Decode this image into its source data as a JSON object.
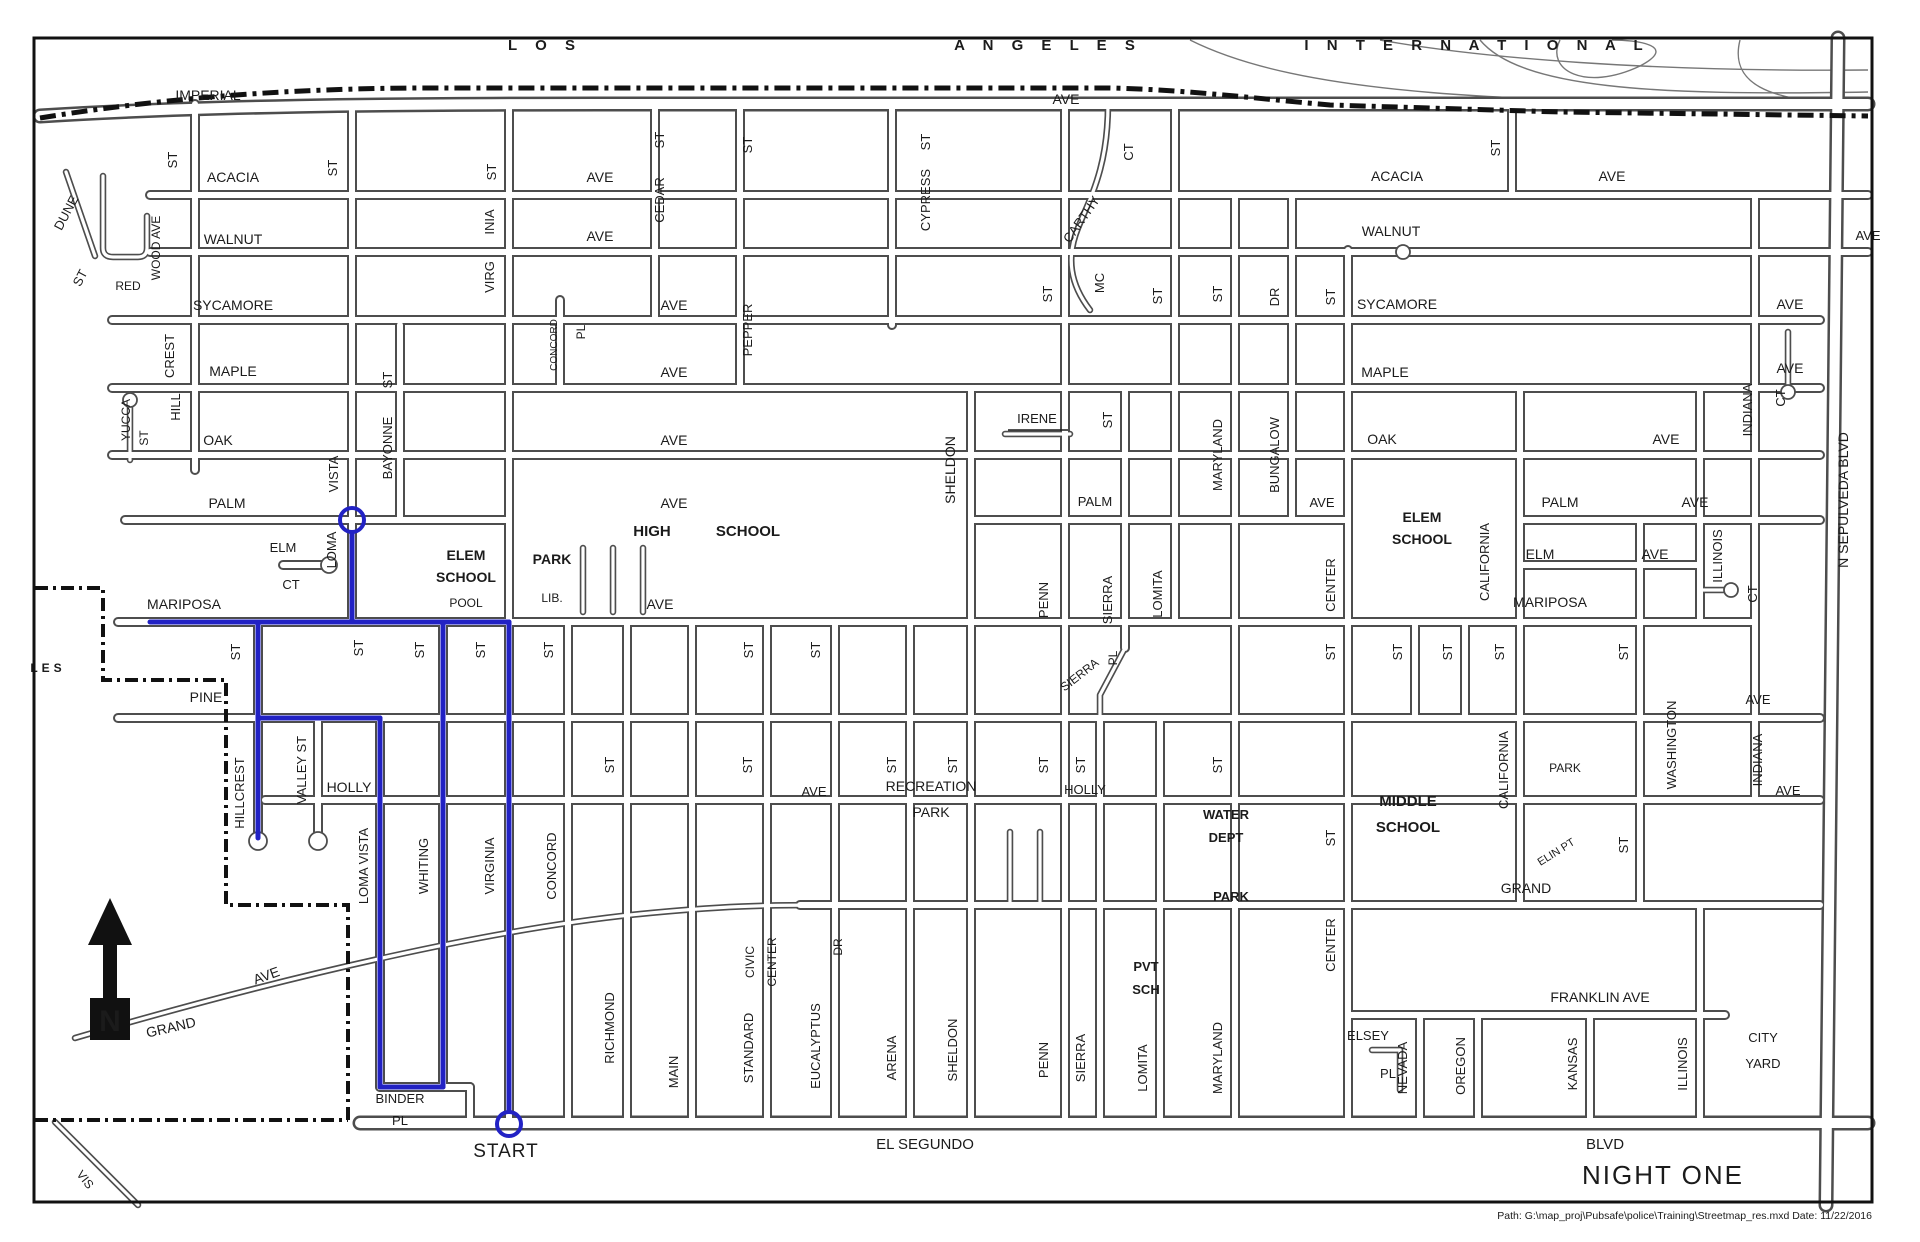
{
  "banner": {
    "word1": "L O S",
    "word2": "A N G E L E S",
    "word3": "I N T E R N A T I O N A L"
  },
  "night_label": {
    "text": "NIGHT ONE",
    "color": "#e0435c"
  },
  "start_label": "START",
  "north_indicator": "N",
  "footer": "Path: G:\\map_proj\\Pubsafe\\police\\Training\\Streetmap_res.mxd    Date: 11/22/2016",
  "route": {
    "color": "#2222c4",
    "segments": [
      "M352,533 L352,622",
      "M150,622 L509,622",
      "M258,622 L258,838",
      "M258,718 L380,718",
      "M380,718 L380,1087",
      "M380,1087 L443,1087",
      "M443,1087 L443,622",
      "M509,622 L509,1110"
    ],
    "rings": [
      {
        "x": 352,
        "y": 520
      },
      {
        "x": 509,
        "y": 1124
      }
    ],
    "start_text": {
      "x": 506,
      "y": 1157
    }
  },
  "labels": [
    {
      "t": "IMPERIAL",
      "x": 208,
      "y": 100
    },
    {
      "t": "AVE",
      "x": 1066,
      "y": 104
    },
    {
      "t": "ACACIA",
      "x": 233,
      "y": 182
    },
    {
      "t": "AVE",
      "x": 600,
      "y": 182
    },
    {
      "t": "ACACIA",
      "x": 1397,
      "y": 181
    },
    {
      "t": "AVE",
      "x": 1612,
      "y": 181
    },
    {
      "t": "ST",
      "x": 177,
      "y": 160,
      "r": -90,
      "s": 13
    },
    {
      "t": "ST",
      "x": 337,
      "y": 168,
      "r": -90,
      "s": 13
    },
    {
      "t": "ST",
      "x": 496,
      "y": 172,
      "r": -90,
      "s": 13
    },
    {
      "t": "ST",
      "x": 664,
      "y": 140,
      "r": -90,
      "s": 13
    },
    {
      "t": "CEDAR",
      "x": 664,
      "y": 200,
      "r": -90,
      "s": 13
    },
    {
      "t": "ST",
      "x": 752,
      "y": 145,
      "r": -90,
      "s": 13
    },
    {
      "t": "PEPPER",
      "x": 752,
      "y": 330,
      "r": -90,
      "s": 13
    },
    {
      "t": "ST",
      "x": 930,
      "y": 142,
      "r": -90,
      "s": 13
    },
    {
      "t": "CYPRESS",
      "x": 930,
      "y": 200,
      "r": -90,
      "s": 13
    },
    {
      "t": "CT",
      "x": 1133,
      "y": 152,
      "r": -90,
      "s": 13
    },
    {
      "t": "CARTHY",
      "x": 1085,
      "y": 222,
      "r": -55,
      "s": 13
    },
    {
      "t": "MC",
      "x": 1104,
      "y": 283,
      "r": -90,
      "s": 13
    },
    {
      "t": "ST",
      "x": 1500,
      "y": 148,
      "r": -90,
      "s": 13
    },
    {
      "t": "WALNUT",
      "x": 233,
      "y": 244
    },
    {
      "t": "AVE",
      "x": 600,
      "y": 241
    },
    {
      "t": "WALNUT",
      "x": 1391,
      "y": 236
    },
    {
      "t": "AVE",
      "x": 1868,
      "y": 240,
      "s": 13
    },
    {
      "t": "INIA",
      "x": 494,
      "y": 222,
      "r": -90,
      "s": 13
    },
    {
      "t": "VIRG",
      "x": 494,
      "y": 277,
      "r": -90,
      "s": 13
    },
    {
      "t": "SYCAMORE",
      "x": 233,
      "y": 310
    },
    {
      "t": "AVE",
      "x": 674,
      "y": 310
    },
    {
      "t": "SYCAMORE",
      "x": 1397,
      "y": 309
    },
    {
      "t": "AVE",
      "x": 1790,
      "y": 309
    },
    {
      "t": "ST",
      "x": 1052,
      "y": 294,
      "r": -90,
      "s": 13
    },
    {
      "t": "ST",
      "x": 1162,
      "y": 296,
      "r": -90,
      "s": 13
    },
    {
      "t": "ST",
      "x": 1222,
      "y": 294,
      "r": -90,
      "s": 13
    },
    {
      "t": "DR",
      "x": 1279,
      "y": 297,
      "r": -90,
      "s": 13
    },
    {
      "t": "ST",
      "x": 1335,
      "y": 297,
      "r": -90,
      "s": 13
    },
    {
      "t": "MAPLE",
      "x": 233,
      "y": 376
    },
    {
      "t": "CONCORD",
      "x": 557,
      "y": 345,
      "r": -90,
      "s": 10
    },
    {
      "t": "PL",
      "x": 585,
      "y": 332,
      "r": -90,
      "s": 12
    },
    {
      "t": "AVE",
      "x": 674,
      "y": 377
    },
    {
      "t": "MAPLE",
      "x": 1385,
      "y": 377
    },
    {
      "t": "AVE",
      "x": 1790,
      "y": 373
    },
    {
      "t": "DUNE",
      "x": 70,
      "y": 215,
      "r": -62,
      "s": 13
    },
    {
      "t": "ST",
      "x": 84,
      "y": 280,
      "r": -62,
      "s": 13
    },
    {
      "t": "RED",
      "x": 128,
      "y": 290,
      "s": 12
    },
    {
      "t": "WOOD AVE",
      "x": 160,
      "y": 248,
      "r": -90,
      "s": 12
    },
    {
      "t": "CREST",
      "x": 174,
      "y": 356,
      "r": -90,
      "s": 13
    },
    {
      "t": "HILL",
      "x": 180,
      "y": 407,
      "r": -90,
      "s": 13
    },
    {
      "t": "YUCCA",
      "x": 130,
      "y": 420,
      "r": -90,
      "s": 12
    },
    {
      "t": "ST",
      "x": 148,
      "y": 438,
      "r": -90,
      "s": 12
    },
    {
      "t": "OAK",
      "x": 218,
      "y": 445
    },
    {
      "t": "AVE",
      "x": 674,
      "y": 445
    },
    {
      "t": "OAK",
      "x": 1382,
      "y": 444
    },
    {
      "t": "AVE",
      "x": 1666,
      "y": 444
    },
    {
      "t": "MARYLAND",
      "x": 1222,
      "y": 455,
      "r": -90,
      "s": 13
    },
    {
      "t": "BUNGALOW",
      "x": 1279,
      "y": 455,
      "r": -90,
      "s": 13
    },
    {
      "t": "INDIANA",
      "x": 1752,
      "y": 410,
      "r": -90,
      "s": 13
    },
    {
      "t": "CT",
      "x": 1785,
      "y": 398,
      "r": -90,
      "s": 13
    },
    {
      "t": "IRENE",
      "x": 1037,
      "y": 423,
      "s": 13
    },
    {
      "t": "ST",
      "x": 1112,
      "y": 420,
      "r": -90,
      "s": 13
    },
    {
      "t": "PALM",
      "x": 227,
      "y": 508
    },
    {
      "t": "AVE",
      "x": 674,
      "y": 508
    },
    {
      "t": "PALM",
      "x": 1095,
      "y": 506,
      "s": 13
    },
    {
      "t": "AVE",
      "x": 1322,
      "y": 507,
      "s": 13
    },
    {
      "t": "PALM",
      "x": 1560,
      "y": 507
    },
    {
      "t": "AVE",
      "x": 1695,
      "y": 507
    },
    {
      "t": "VISTA",
      "x": 338,
      "y": 474,
      "r": -90,
      "s": 13
    },
    {
      "t": "LOMA",
      "x": 336,
      "y": 550,
      "r": -90,
      "s": 13
    },
    {
      "t": "ST",
      "x": 392,
      "y": 380,
      "r": -90,
      "s": 13
    },
    {
      "t": "BAYONNE",
      "x": 392,
      "y": 448,
      "r": -90,
      "s": 13
    },
    {
      "t": "ELM",
      "x": 283,
      "y": 552,
      "s": 13
    },
    {
      "t": "CT",
      "x": 291,
      "y": 589,
      "s": 13
    },
    {
      "t": "ELM",
      "x": 1540,
      "y": 559
    },
    {
      "t": "AVE",
      "x": 1655,
      "y": 559
    },
    {
      "t": "ELEM",
      "x": 466,
      "y": 560,
      "w": "bold"
    },
    {
      "t": "SCHOOL",
      "x": 466,
      "y": 582,
      "w": "bold"
    },
    {
      "t": "POOL",
      "x": 466,
      "y": 607,
      "s": 12
    },
    {
      "t": "PARK",
      "x": 552,
      "y": 564,
      "w": "bold"
    },
    {
      "t": "LIB.",
      "x": 552,
      "y": 602,
      "s": 12
    },
    {
      "t": "HIGH",
      "x": 652,
      "y": 536,
      "s": 15,
      "w": "bold"
    },
    {
      "t": "SCHOOL",
      "x": 748,
      "y": 536,
      "s": 15,
      "w": "bold"
    },
    {
      "t": "SHELDON",
      "x": 955,
      "y": 470,
      "r": -90
    },
    {
      "t": "MARIPOSA",
      "x": 184,
      "y": 609
    },
    {
      "t": "AVE",
      "x": 660,
      "y": 609
    },
    {
      "t": "MARIPOSA",
      "x": 1550,
      "y": 607
    },
    {
      "t": "ELEM",
      "x": 1422,
      "y": 522,
      "w": "bold"
    },
    {
      "t": "SCHOOL",
      "x": 1422,
      "y": 544,
      "w": "bold"
    },
    {
      "t": "CALIFORNIA",
      "x": 1489,
      "y": 562,
      "r": -90,
      "s": 13
    },
    {
      "t": "ILLINOIS",
      "x": 1722,
      "y": 556,
      "r": -90,
      "s": 13
    },
    {
      "t": "CT",
      "x": 1757,
      "y": 594,
      "r": -90,
      "s": 13
    },
    {
      "t": "CENTER",
      "x": 1335,
      "y": 585,
      "r": -90,
      "s": 13
    },
    {
      "t": "PENN",
      "x": 1048,
      "y": 600,
      "r": -90,
      "s": 13
    },
    {
      "t": "SIERRA",
      "x": 1112,
      "y": 600,
      "r": -90,
      "s": 13
    },
    {
      "t": "LOMITA",
      "x": 1162,
      "y": 594,
      "r": -90,
      "s": 13
    },
    {
      "t": "ST",
      "x": 240,
      "y": 652,
      "r": -90,
      "s": 13
    },
    {
      "t": "ST",
      "x": 363,
      "y": 648,
      "r": -90,
      "s": 13
    },
    {
      "t": "ST",
      "x": 424,
      "y": 650,
      "r": -90,
      "s": 13
    },
    {
      "t": "ST",
      "x": 485,
      "y": 650,
      "r": -90,
      "s": 13
    },
    {
      "t": "ST",
      "x": 553,
      "y": 650,
      "r": -90,
      "s": 13
    },
    {
      "t": "ST",
      "x": 753,
      "y": 650,
      "r": -90,
      "s": 13
    },
    {
      "t": "ST",
      "x": 820,
      "y": 650,
      "r": -90,
      "s": 13
    },
    {
      "t": "ST",
      "x": 1335,
      "y": 652,
      "r": -90,
      "s": 13
    },
    {
      "t": "ST",
      "x": 1402,
      "y": 652,
      "r": -90,
      "s": 13
    },
    {
      "t": "ST",
      "x": 1452,
      "y": 652,
      "r": -90,
      "s": 13
    },
    {
      "t": "ST",
      "x": 1504,
      "y": 652,
      "r": -90,
      "s": 13
    },
    {
      "t": "ST",
      "x": 1628,
      "y": 652,
      "r": -90,
      "s": 13
    },
    {
      "t": "SIERRA",
      "x": 1082,
      "y": 678,
      "r": -38,
      "s": 12
    },
    {
      "t": "PL",
      "x": 1117,
      "y": 658,
      "r": -90,
      "s": 12
    },
    {
      "t": "PINE",
      "x": 206,
      "y": 702
    },
    {
      "t": "AVE",
      "x": 1758,
      "y": 704,
      "s": 13
    },
    {
      "t": "HOLLY",
      "x": 349,
      "y": 792
    },
    {
      "t": "AVE",
      "x": 814,
      "y": 796,
      "s": 13
    },
    {
      "t": "HOLLY",
      "x": 1085,
      "y": 794,
      "s": 13
    },
    {
      "t": "RECREATION",
      "x": 931,
      "y": 791
    },
    {
      "t": "PARK",
      "x": 931,
      "y": 817
    },
    {
      "t": "WATER",
      "x": 1226,
      "y": 819,
      "s": 13,
      "w": "bold"
    },
    {
      "t": "DEPT",
      "x": 1226,
      "y": 842,
      "s": 13,
      "w": "bold"
    },
    {
      "t": "PARK",
      "x": 1231,
      "y": 901,
      "s": 13,
      "w": "bold"
    },
    {
      "t": "WASHINGTON",
      "x": 1676,
      "y": 745,
      "r": -90,
      "s": 13
    },
    {
      "t": "INDIANA",
      "x": 1762,
      "y": 760,
      "r": -90,
      "s": 13
    },
    {
      "t": "AVE",
      "x": 1788,
      "y": 795,
      "s": 13
    },
    {
      "t": "PARK",
      "x": 1565,
      "y": 772,
      "s": 12
    },
    {
      "t": "CALIFORNIA",
      "x": 1508,
      "y": 770,
      "r": -90,
      "s": 13
    },
    {
      "t": "ELIN PT",
      "x": 1558,
      "y": 855,
      "r": -32,
      "s": 11
    },
    {
      "t": "MIDDLE",
      "x": 1408,
      "y": 806,
      "s": 15,
      "w": "bold"
    },
    {
      "t": "SCHOOL",
      "x": 1408,
      "y": 832,
      "s": 15,
      "w": "bold"
    },
    {
      "t": "GRAND",
      "x": 1526,
      "y": 893
    },
    {
      "t": "ST",
      "x": 1628,
      "y": 845,
      "r": -90,
      "s": 13
    },
    {
      "t": "ST",
      "x": 1335,
      "y": 838,
      "r": -90,
      "s": 13
    },
    {
      "t": "HILLCREST",
      "x": 244,
      "y": 793,
      "r": -90,
      "s": 13
    },
    {
      "t": "VALLEY ST",
      "x": 306,
      "y": 770,
      "r": -90,
      "s": 13
    },
    {
      "t": "LOMA VISTA",
      "x": 368,
      "y": 866,
      "r": -90,
      "s": 13
    },
    {
      "t": "WHITING",
      "x": 428,
      "y": 866,
      "r": -90,
      "s": 13
    },
    {
      "t": "VIRGINIA",
      "x": 494,
      "y": 866,
      "r": -90,
      "s": 13
    },
    {
      "t": "CONCORD",
      "x": 556,
      "y": 866,
      "r": -90,
      "s": 13
    },
    {
      "t": "CIVIC",
      "x": 754,
      "y": 962,
      "r": -90,
      "s": 12
    },
    {
      "t": "CENTER",
      "x": 776,
      "y": 962,
      "r": -90,
      "s": 12
    },
    {
      "t": "DR",
      "x": 842,
      "y": 947,
      "r": -90,
      "s": 12
    },
    {
      "t": "GRAND",
      "x": 172,
      "y": 1032,
      "r": -13
    },
    {
      "t": "AVE",
      "x": 268,
      "y": 980,
      "r": -20
    },
    {
      "t": "RICHMOND",
      "x": 614,
      "y": 1028,
      "r": -90,
      "s": 13
    },
    {
      "t": "MAIN",
      "x": 678,
      "y": 1072,
      "r": -90,
      "s": 13
    },
    {
      "t": "STANDARD",
      "x": 753,
      "y": 1048,
      "r": -90,
      "s": 13
    },
    {
      "t": "EUCALYPTUS",
      "x": 820,
      "y": 1046,
      "r": -90,
      "s": 13
    },
    {
      "t": "ARENA",
      "x": 896,
      "y": 1058,
      "r": -90,
      "s": 13
    },
    {
      "t": "SHELDON",
      "x": 957,
      "y": 1050,
      "r": -90,
      "s": 13
    },
    {
      "t": "PENN",
      "x": 1048,
      "y": 1060,
      "r": -90,
      "s": 13
    },
    {
      "t": "SIERRA",
      "x": 1085,
      "y": 1058,
      "r": -90,
      "s": 13
    },
    {
      "t": "LOMITA",
      "x": 1147,
      "y": 1068,
      "r": -90,
      "s": 13
    },
    {
      "t": "MARYLAND",
      "x": 1222,
      "y": 1058,
      "r": -90,
      "s": 13
    },
    {
      "t": "ST",
      "x": 614,
      "y": 765,
      "r": -90,
      "s": 13
    },
    {
      "t": "ST",
      "x": 752,
      "y": 765,
      "r": -90,
      "s": 13
    },
    {
      "t": "ST",
      "x": 896,
      "y": 765,
      "r": -90,
      "s": 13
    },
    {
      "t": "ST",
      "x": 957,
      "y": 765,
      "r": -90,
      "s": 13
    },
    {
      "t": "ST",
      "x": 1048,
      "y": 765,
      "r": -90,
      "s": 13
    },
    {
      "t": "ST",
      "x": 1085,
      "y": 765,
      "r": -90,
      "s": 13
    },
    {
      "t": "ST",
      "x": 1222,
      "y": 765,
      "r": -90,
      "s": 13
    },
    {
      "t": "CENTER",
      "x": 1335,
      "y": 945,
      "r": -90,
      "s": 13
    },
    {
      "t": "PVT",
      "x": 1146,
      "y": 971,
      "s": 13,
      "w": "bold"
    },
    {
      "t": "SCH",
      "x": 1146,
      "y": 994,
      "s": 13,
      "w": "bold"
    },
    {
      "t": "FRANKLIN  AVE",
      "x": 1600,
      "y": 1002
    },
    {
      "t": "ELSEY",
      "x": 1368,
      "y": 1040,
      "s": 13
    },
    {
      "t": "PL",
      "x": 1388,
      "y": 1078,
      "s": 13
    },
    {
      "t": "NEVADA",
      "x": 1407,
      "y": 1068,
      "r": -90,
      "s": 13
    },
    {
      "t": "OREGON",
      "x": 1465,
      "y": 1066,
      "r": -90,
      "s": 13
    },
    {
      "t": "KANSAS",
      "x": 1577,
      "y": 1064,
      "r": -90,
      "s": 13
    },
    {
      "t": "ILLINOIS",
      "x": 1687,
      "y": 1064,
      "r": -90,
      "s": 13
    },
    {
      "t": "CITY",
      "x": 1763,
      "y": 1042,
      "s": 13
    },
    {
      "t": "YARD",
      "x": 1763,
      "y": 1068,
      "s": 13
    },
    {
      "t": "BINDER",
      "x": 400,
      "y": 1103,
      "s": 13
    },
    {
      "t": "PL",
      "x": 400,
      "y": 1125,
      "s": 13
    },
    {
      "t": "EL SEGUNDO",
      "x": 925,
      "y": 1149,
      "s": 15
    },
    {
      "t": "BLVD",
      "x": 1605,
      "y": 1149,
      "s": 15
    },
    {
      "t": "N  SEPULVEDA  BLVD",
      "x": 1848,
      "y": 500,
      "r": -90
    },
    {
      "t": "LES",
      "x": 48,
      "y": 672,
      "s": 12,
      "w": "bold",
      "ls": 4
    },
    {
      "t": "VIS",
      "x": 82,
      "y": 1182,
      "r": 52,
      "s": 12
    }
  ]
}
